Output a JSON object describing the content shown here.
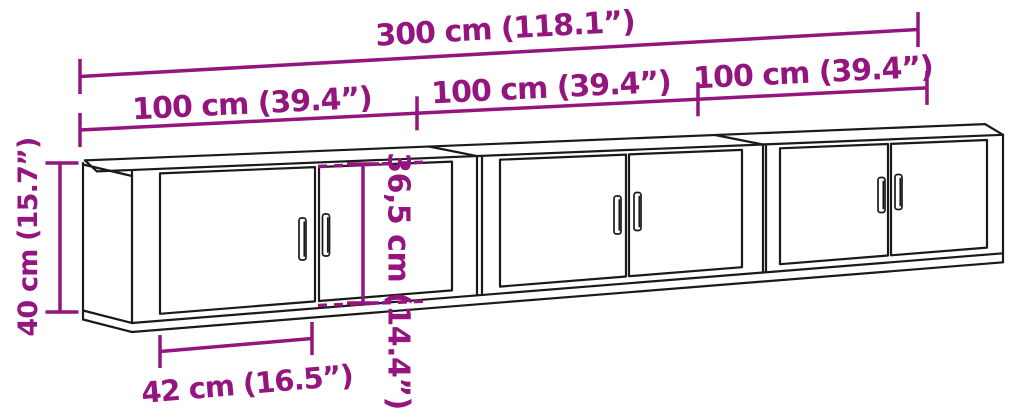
{
  "diagram": {
    "type": "furniture-dimension-diagram",
    "cabinet_count": 3,
    "labels": {
      "total_width": "300 cm (118.1”)",
      "section_widths": [
        "100 cm (39.4”)",
        "100 cm (39.4”)",
        "100 cm (39.4”)"
      ],
      "height": "40 cm (15.7”)",
      "inner_height": "36,5 cm (14.4”)",
      "door_width": "42 cm (16.5”)"
    },
    "colors": {
      "dimension": "#94157E",
      "outline": "#1a1a1a",
      "background": "#ffffff"
    }
  }
}
